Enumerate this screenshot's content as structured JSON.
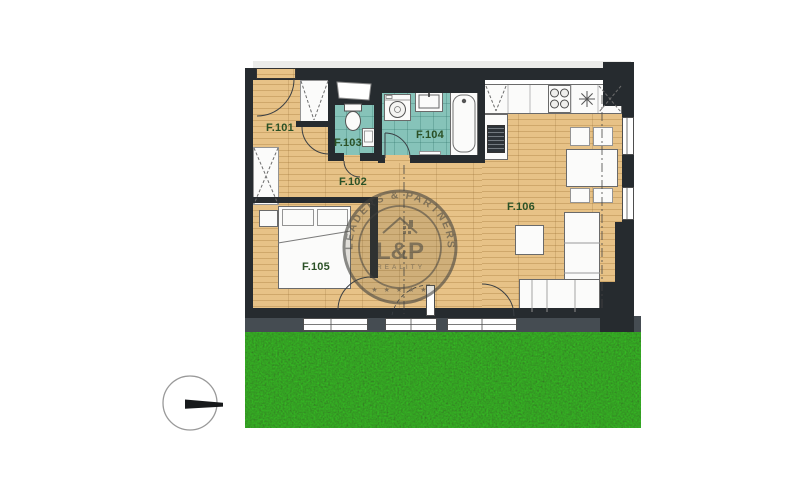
{
  "plan": {
    "room_labels": {
      "f101": "F.101",
      "f102": "F.102",
      "f103": "F.103",
      "f104": "F.104",
      "f105": "F.105",
      "f106": "F.106"
    }
  },
  "watermark": {
    "ring_text": "LEADERS & PARTNERS",
    "monogram": "L&P",
    "subtitle": "REALITY",
    "stars": "★ ★ ★ ★ ★"
  },
  "colors": {
    "wall": "#262b2f",
    "wood_floor": "#e7c287",
    "bathroom_tile": "#86c3b9",
    "room_label": "#2b5126",
    "grass": "#1e3f12",
    "terrace": "#454c52",
    "fixture": "#fbfbfa",
    "watermark_ink": "#45443f"
  }
}
